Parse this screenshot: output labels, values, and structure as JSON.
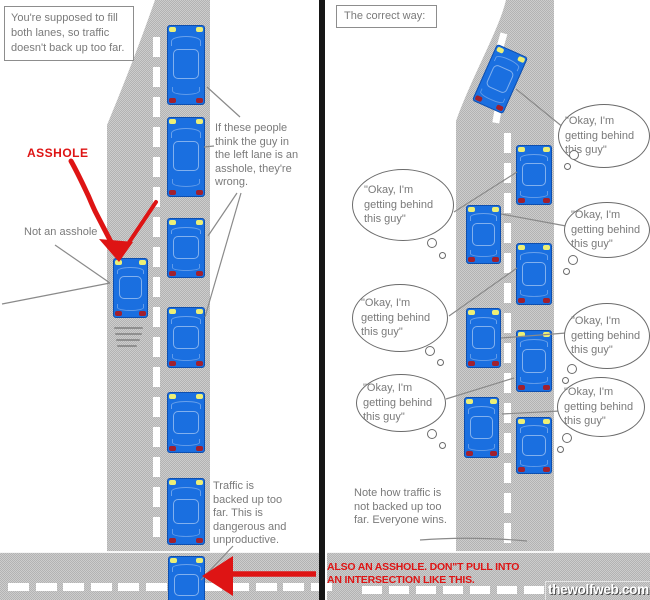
{
  "left_panel": {
    "caption": "You're supposed to fill both lanes, so traffic doesn't back up too far.",
    "asshole_label": "ASSHOLE",
    "not_asshole_label": "Not an asshole",
    "wrong_note": "If these people think the guy in the left lane is an asshole, they're wrong.",
    "traffic_note": "Traffic is backed up too far. This is dangerous and unproductive."
  },
  "right_panel": {
    "caption": "The correct way:",
    "thought_bubble": "\"Okay, I'm getting behind this guy\"",
    "note": "Note how traffic is not backed up too far. Everyone wins."
  },
  "bottom_note_red": "ALSO AN ASSHOLE.  DON\"T PULL INTO AN INTERSECTION LIKE THIS.",
  "watermark": "thewolfweb.com",
  "colors": {
    "car_blue": "#1a6fe0",
    "car_border": "#0d4fb0",
    "headlight": "#ecef76",
    "taillight": "#a1202e",
    "annotation_red": "#de1414",
    "pointer_gray": "#8a8a8a",
    "text_gray": "#7a7a7a",
    "road_light": "#cdcdcd",
    "road_dark": "#b3b3b3",
    "divider_black": "#161616",
    "bubble_border": "#6b6b6b"
  }
}
